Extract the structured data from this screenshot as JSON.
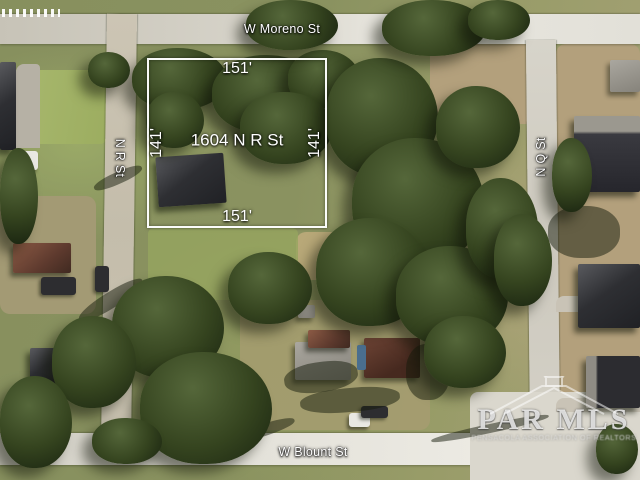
{
  "map": {
    "type": "aerial-satellite-parcel-view"
  },
  "streets": {
    "top": "W Moreno St",
    "left": "N R St",
    "right": "N Q St",
    "bottom": "W Blount St"
  },
  "parcel": {
    "address": "1604 N R St",
    "frontage_top": "151'",
    "frontage_bottom": "151'",
    "depth_left": "141'",
    "depth_right": "141'",
    "outline_color": "#ffffff"
  },
  "watermark": {
    "name": "PAR MLS",
    "subtitle": "PENSACOLA ASSOCIATION OF REALTORS",
    "icon": "house-roof-icon"
  },
  "colors": {
    "label_text": "#ffffff",
    "road": "#d8d5cc",
    "grass": "#8d9565",
    "dirt": "#b3a07c",
    "tree_canopy": "#31401f",
    "roof_dark": "#2e2f33",
    "roof_red": "#5e3a2e"
  },
  "scene": {
    "patches": [
      {
        "c": "dirt",
        "x": 556,
        "y": 44,
        "w": 84,
        "h": 392
      },
      {
        "c": "dirt",
        "x": 430,
        "y": 44,
        "w": 126,
        "h": 80
      },
      {
        "c": "dirt",
        "x": 0,
        "y": 196,
        "w": 96,
        "h": 118,
        "bg": "#a39a74"
      },
      {
        "c": "lawn",
        "x": 6,
        "y": 70,
        "w": 100,
        "h": 74
      },
      {
        "c": "dirt",
        "x": 240,
        "y": 300,
        "w": 190,
        "h": 130,
        "bg": "rgba(170,156,115,0.7)"
      },
      {
        "c": "dirt",
        "x": 296,
        "y": 232,
        "w": 62,
        "h": 48,
        "bg": "#b8a878"
      },
      {
        "c": "concrete",
        "x": 470,
        "y": 392,
        "w": 170,
        "h": 88
      },
      {
        "c": "concrete",
        "x": 16,
        "y": 64,
        "w": 24,
        "h": 84,
        "bg": "#b6b1a5"
      },
      {
        "c": "lawn",
        "x": 148,
        "y": 228,
        "w": 150,
        "h": 72,
        "bg": "rgba(150,165,95,0.8)"
      },
      {
        "c": "concrete",
        "x": 556,
        "y": 296,
        "w": 84,
        "h": 16,
        "bg": "#c9c3b6"
      },
      {
        "c": "concrete",
        "x": 556,
        "y": 398,
        "w": 84,
        "h": 14,
        "bg": "#c9c3b6"
      }
    ],
    "buildings": [
      {
        "c": "bdark",
        "x": 157,
        "y": 155,
        "w": 68,
        "h": 50,
        "rot": -4
      },
      {
        "c": "bdark",
        "x": 0,
        "y": 62,
        "w": 16,
        "h": 88
      },
      {
        "c": "bred",
        "x": 13,
        "y": 243,
        "w": 58,
        "h": 30
      },
      {
        "c": "bdark",
        "x": 30,
        "y": 348,
        "w": 36,
        "h": 38
      },
      {
        "c": "bgray",
        "x": 80,
        "y": 338,
        "w": 20,
        "h": 16
      },
      {
        "c": "bgray",
        "x": 295,
        "y": 342,
        "w": 56,
        "h": 38
      },
      {
        "c": "bred",
        "x": 308,
        "y": 330,
        "w": 42,
        "h": 18
      },
      {
        "c": "bred",
        "x": 364,
        "y": 338,
        "w": 56,
        "h": 40,
        "bg": "linear-gradient(150deg,#6e4435,#46291f 70%)"
      },
      {
        "c": "bgray",
        "x": 610,
        "y": 60,
        "w": 30,
        "h": 32
      },
      {
        "c": "bdark",
        "x": 574,
        "y": 116,
        "w": 66,
        "h": 76,
        "bg": "linear-gradient(180deg,#9b988f 0%,#9b988f 20%,#3a3a40 24%,#26262c 100%)"
      },
      {
        "c": "bdark",
        "x": 578,
        "y": 264,
        "w": 62,
        "h": 64
      },
      {
        "c": "bdark",
        "x": 586,
        "y": 356,
        "w": 54,
        "h": 52,
        "bg": "linear-gradient(90deg,#8f8c84 0 18%,#2c2c30 22%)"
      },
      {
        "c": "bgray",
        "x": 298,
        "y": 305,
        "w": 17,
        "h": 13
      }
    ],
    "vehicles": [
      {
        "c": "vwhite",
        "x": 13,
        "y": 151,
        "w": 25,
        "h": 19
      },
      {
        "c": "vdark",
        "x": 41,
        "y": 277,
        "w": 35,
        "h": 18
      },
      {
        "c": "vdark",
        "x": 95,
        "y": 266,
        "w": 14,
        "h": 26
      },
      {
        "c": "vwhite",
        "x": 349,
        "y": 413,
        "w": 21,
        "h": 14
      },
      {
        "c": "vdark",
        "x": 361,
        "y": 406,
        "w": 27,
        "h": 12
      },
      {
        "c": "vblue",
        "x": 357,
        "y": 345,
        "w": 9,
        "h": 25
      }
    ],
    "trees": [
      {
        "c": "tree",
        "x": 132,
        "y": 48,
        "w": 95,
        "h": 62
      },
      {
        "c": "tree",
        "x": 212,
        "y": 55,
        "w": 112,
        "h": 78
      },
      {
        "c": "tree",
        "x": 288,
        "y": 50,
        "w": 72,
        "h": 58
      },
      {
        "c": "tree",
        "x": 240,
        "y": 92,
        "w": 92,
        "h": 72
      },
      {
        "c": "tree",
        "x": 146,
        "y": 92,
        "w": 58,
        "h": 56
      },
      {
        "c": "tree",
        "x": 326,
        "y": 58,
        "w": 112,
        "h": 118
      },
      {
        "c": "tree",
        "x": 352,
        "y": 138,
        "w": 132,
        "h": 128
      },
      {
        "c": "tree",
        "x": 316,
        "y": 218,
        "w": 112,
        "h": 108
      },
      {
        "c": "tree",
        "x": 396,
        "y": 246,
        "w": 112,
        "h": 100
      },
      {
        "c": "tree",
        "x": 436,
        "y": 86,
        "w": 84,
        "h": 82
      },
      {
        "c": "tree",
        "x": 466,
        "y": 178,
        "w": 72,
        "h": 100
      },
      {
        "c": "tree",
        "x": 228,
        "y": 252,
        "w": 84,
        "h": 72
      },
      {
        "c": "tree",
        "x": 112,
        "y": 276,
        "w": 112,
        "h": 102
      },
      {
        "c": "tree",
        "x": 140,
        "y": 352,
        "w": 132,
        "h": 112
      },
      {
        "c": "tree",
        "x": 52,
        "y": 316,
        "w": 84,
        "h": 92
      },
      {
        "c": "tree",
        "x": 0,
        "y": 376,
        "w": 72,
        "h": 92
      },
      {
        "c": "tree",
        "x": 424,
        "y": 316,
        "w": 82,
        "h": 72
      },
      {
        "c": "tree",
        "x": 494,
        "y": 214,
        "w": 58,
        "h": 92
      },
      {
        "c": "tree",
        "x": 246,
        "y": 0,
        "w": 92,
        "h": 50
      },
      {
        "c": "tree",
        "x": 382,
        "y": 0,
        "w": 104,
        "h": 56
      },
      {
        "c": "tree",
        "x": 468,
        "y": 0,
        "w": 62,
        "h": 40
      },
      {
        "c": "tree",
        "x": 88,
        "y": 52,
        "w": 42,
        "h": 36
      },
      {
        "c": "tree",
        "x": 552,
        "y": 138,
        "w": 40,
        "h": 74
      },
      {
        "c": "tree",
        "x": 596,
        "y": 424,
        "w": 42,
        "h": 50
      },
      {
        "c": "tree",
        "x": 92,
        "y": 418,
        "w": 70,
        "h": 46
      },
      {
        "c": "tree",
        "x": 0,
        "y": 148,
        "w": 38,
        "h": 96
      }
    ],
    "shadows": [
      {
        "c": "shadow",
        "x": 74,
        "y": 292,
        "w": 74,
        "h": 16,
        "rot": -32
      },
      {
        "c": "shadow",
        "x": 82,
        "y": 332,
        "w": 84,
        "h": 14,
        "rot": -28
      },
      {
        "c": "shadow",
        "x": 92,
        "y": 172,
        "w": 52,
        "h": 12,
        "rot": -24
      },
      {
        "c": "shadow",
        "x": 136,
        "y": 428,
        "w": 92,
        "h": 14,
        "rot": -14
      },
      {
        "c": "shadow",
        "x": 232,
        "y": 424,
        "w": 64,
        "h": 12,
        "rot": -18
      },
      {
        "c": "shadow",
        "x": 284,
        "y": 362,
        "w": 74,
        "h": 30,
        "rot": -8
      },
      {
        "c": "shadow",
        "x": 406,
        "y": 344,
        "w": 44,
        "h": 56
      },
      {
        "c": "shadow",
        "x": 548,
        "y": 206,
        "w": 72,
        "h": 52
      },
      {
        "c": "shadow",
        "x": 300,
        "y": 388,
        "w": 100,
        "h": 24,
        "rot": -5
      },
      {
        "c": "shadow",
        "x": 430,
        "y": 424,
        "w": 120,
        "h": 9,
        "rot": -12
      }
    ]
  }
}
